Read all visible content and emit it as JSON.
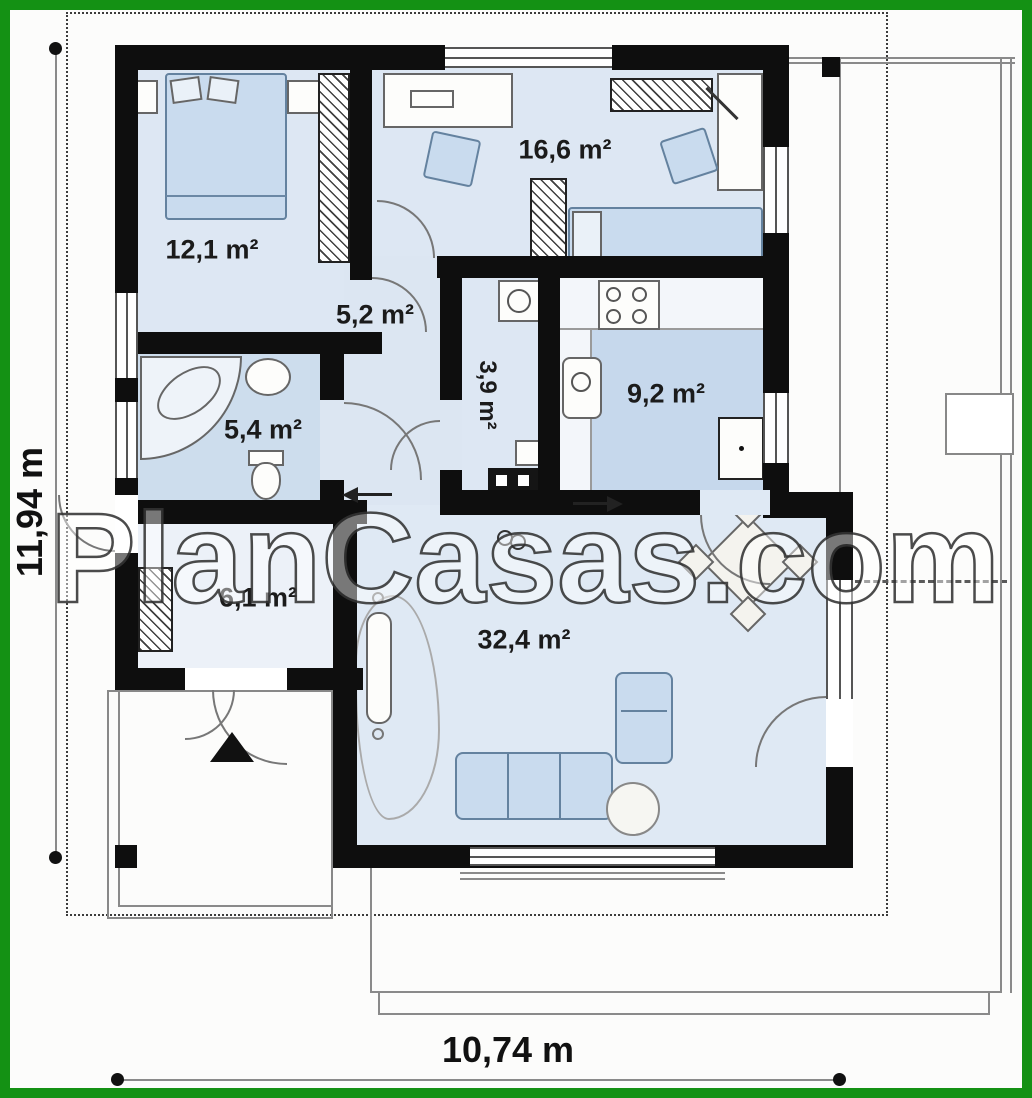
{
  "title": "Single-storey house floor plan",
  "watermark": "PlanCasas.com",
  "dimensions": {
    "height_label": "11,94 m",
    "width_label": "10,74 m"
  },
  "rooms": {
    "bedroom1": {
      "label": "12,1 m²"
    },
    "bedroom2": {
      "label": "16,6 m²"
    },
    "hallway": {
      "label": "5,2 m²"
    },
    "utility": {
      "label": "3,9 m²"
    },
    "bathroom": {
      "label": "5,4 m²"
    },
    "kitchen": {
      "label": "9,2 m²"
    },
    "entry": {
      "label": "6,1 m²"
    },
    "living": {
      "label": "32,4 m²"
    }
  },
  "colors": {
    "border_green": "#149114",
    "wall": "#0e0e0e",
    "floor_light": "#dde7f3",
    "floor_medium": "#cddded",
    "floor_dark": "#c6d8ec",
    "furniture_blue": "#c9dbee"
  }
}
